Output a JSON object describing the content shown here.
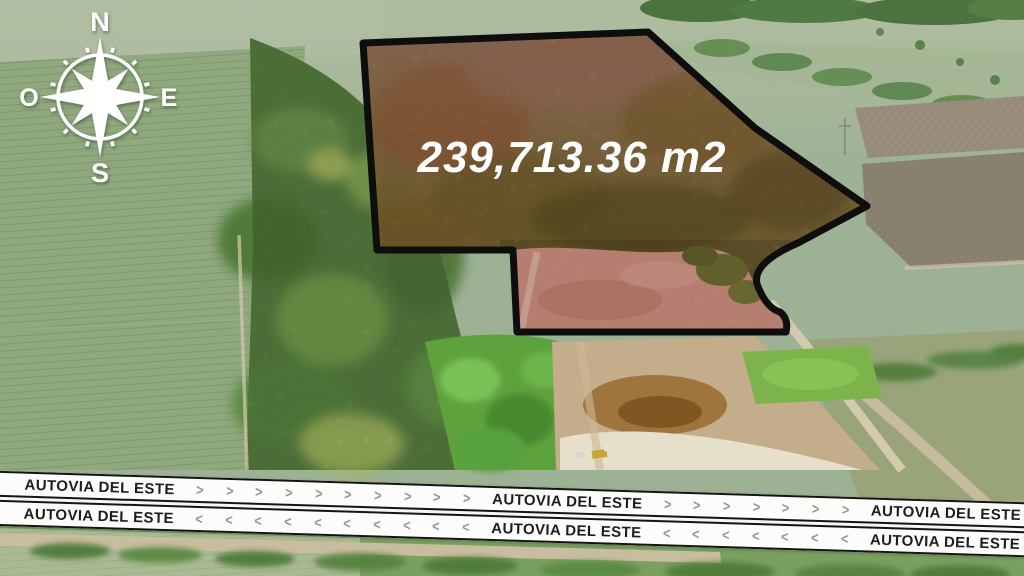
{
  "parcel": {
    "area_label": "239,713.36 m2",
    "outline_color": "#0e0e0e",
    "brush_fill_color": "#8a6f3a",
    "cleared_fill_color": "#d09080"
  },
  "compass": {
    "north": "N",
    "east": "E",
    "south": "S",
    "west": "O"
  },
  "banners": {
    "road_name": "AUTOVIA DEL ESTE",
    "arrow_right": ">",
    "arrow_left": "<",
    "strip_color": "#fcfcfb",
    "text_color": "#1e1e1e",
    "arrow_color": "#969696"
  }
}
